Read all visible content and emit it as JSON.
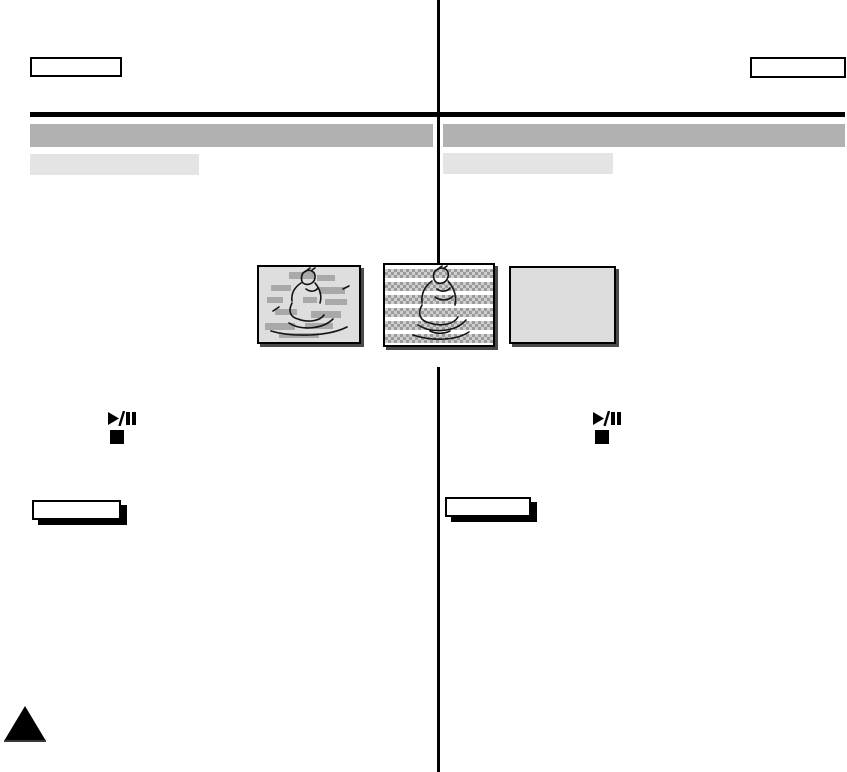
{
  "header": {
    "left_box_label": "",
    "right_box_label": ""
  },
  "sections": {
    "left": {
      "title": "",
      "subtitle": ""
    },
    "right": {
      "title": "",
      "subtitle": ""
    }
  },
  "controls": {
    "left": {
      "play_pause_glyph": "play-pause",
      "stop_glyph": "stop"
    },
    "right": {
      "play_pause_glyph": "play-pause",
      "stop_glyph": "stop"
    }
  },
  "notes": {
    "left_label": "",
    "right_label": ""
  },
  "figures": [
    {
      "name": "playback-picture",
      "background": "#dedede"
    },
    {
      "name": "playback-noise-bands",
      "background": "#ffffff"
    },
    {
      "name": "blank-screen",
      "background": "#dcdcdc"
    }
  ],
  "colors": {
    "page_background": "#ffffff",
    "title_bar": "#b1b1b1",
    "subtitle_bar": "#e4e4e4",
    "header_rule": "#000000",
    "column_divider": "#000000",
    "note_box_shadow": "#000000",
    "figure_shadow": "#4a4a4a",
    "noise_band": "#9b9b9b",
    "corner_triangle": "#000000"
  }
}
